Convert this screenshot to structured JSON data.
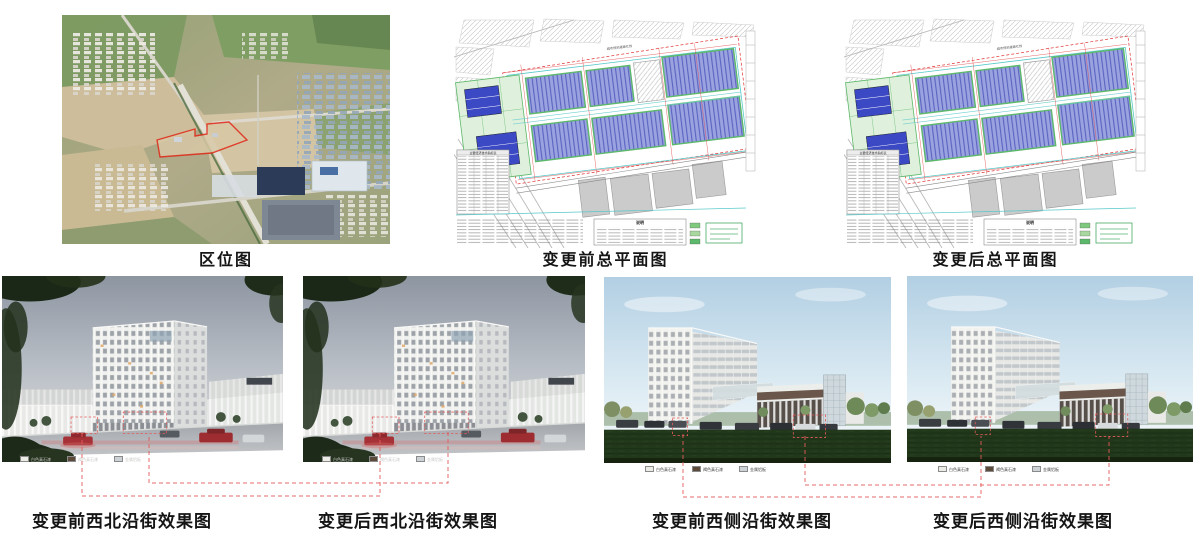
{
  "panels": [
    {
      "caption": "区位图"
    },
    {
      "caption": "变更前总平面图"
    },
    {
      "caption": "变更后总平面图"
    },
    {
      "caption": "变更前西北沿街效果图"
    },
    {
      "caption": "变更后西北沿街效果图"
    },
    {
      "caption": "变更前西侧沿街效果图"
    },
    {
      "caption": "变更后西侧沿街效果图"
    }
  ],
  "site_plan": {
    "road_label": "城市规划道路红线",
    "table_title": "主要经济技术指标表",
    "notes_title": "说明"
  },
  "legend": {
    "items": [
      {
        "label": "白色真石漆",
        "swatch_style": "background:#ecebe5"
      },
      {
        "label": "褐色真石漆",
        "swatch_style": "background:#5c4a3a"
      },
      {
        "label": "金属铝板",
        "swatch_style": "background:#cdd2d6"
      }
    ]
  },
  "colors": {
    "annotation_red": "#e35b5b",
    "site_boundary_red": "#e02818",
    "plan_building_blue": "#9aa2e0",
    "plan_green": "#5cb86a",
    "lawn_green": "#22381b"
  }
}
